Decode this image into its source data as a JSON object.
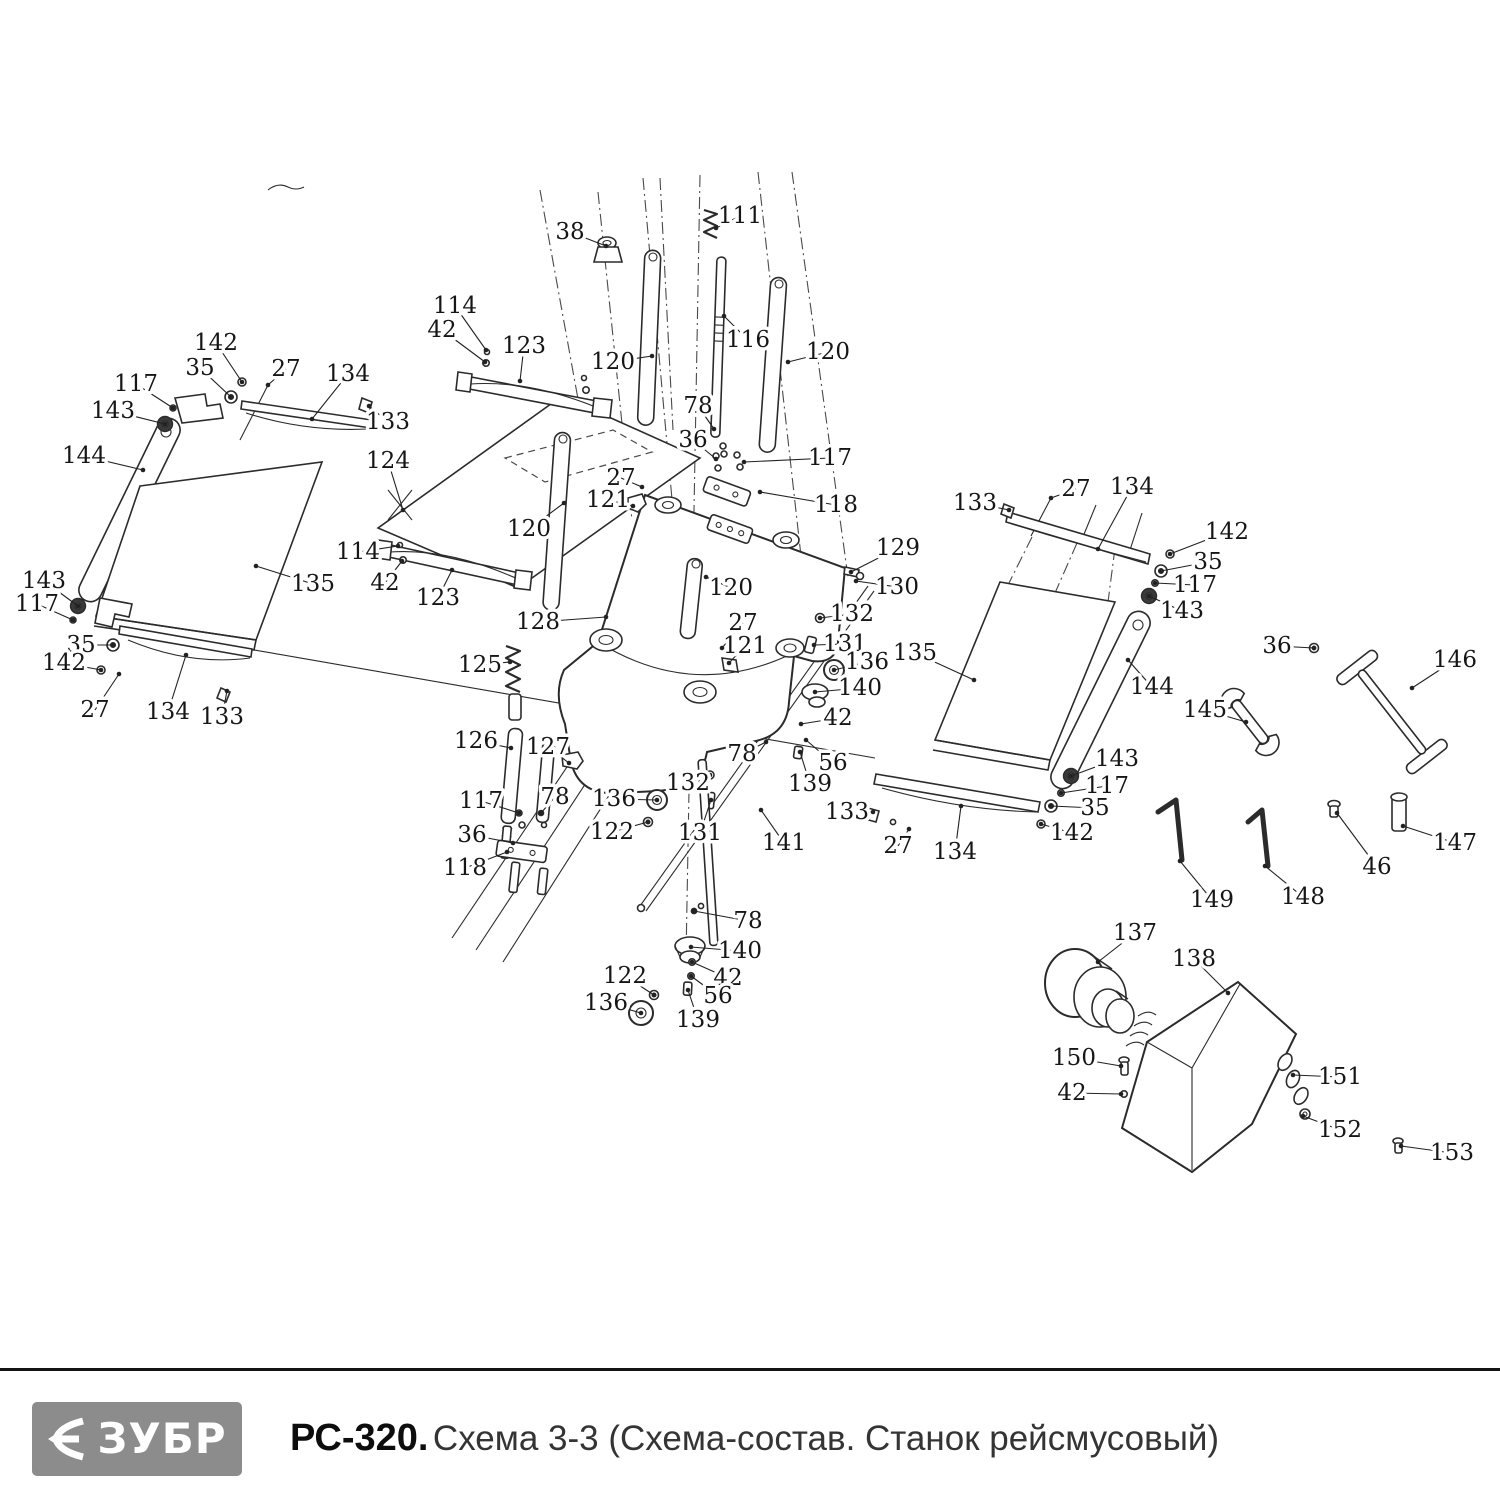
{
  "footer": {
    "brand": "ЗУБР",
    "model": "РС-320.",
    "title": "Схема 3-3 (Схема-состав. Станок рейсмусовый)"
  },
  "diagram": {
    "callouts": [
      {
        "t": "38",
        "x": 570,
        "y": 232,
        "tx": 606,
        "ty": 246
      },
      {
        "t": "111",
        "x": 740,
        "y": 216,
        "tx": 716,
        "ty": 228
      },
      {
        "t": "114",
        "x": 455,
        "y": 306,
        "tx": 486,
        "ty": 350
      },
      {
        "t": "42",
        "x": 442,
        "y": 330,
        "tx": 485,
        "ty": 362
      },
      {
        "t": "123",
        "x": 524,
        "y": 346,
        "tx": 520,
        "ty": 381
      },
      {
        "t": "120",
        "x": 613,
        "y": 362,
        "tx": 652,
        "ty": 356
      },
      {
        "t": "116",
        "x": 748,
        "y": 340,
        "tx": 724,
        "ty": 316
      },
      {
        "t": "120",
        "x": 828,
        "y": 352,
        "tx": 788,
        "ty": 362
      },
      {
        "t": "78",
        "x": 698,
        "y": 406,
        "tx": 714,
        "ty": 429
      },
      {
        "t": "36",
        "x": 693,
        "y": 440,
        "tx": 716,
        "ty": 459
      },
      {
        "t": "117",
        "x": 830,
        "y": 458,
        "tx": 744,
        "ty": 462
      },
      {
        "t": "27",
        "x": 621,
        "y": 478,
        "tx": 642,
        "ty": 487
      },
      {
        "t": "121",
        "x": 608,
        "y": 500,
        "tx": 633,
        "ty": 506
      },
      {
        "t": "118",
        "x": 836,
        "y": 505,
        "tx": 760,
        "ty": 492
      },
      {
        "t": "142",
        "x": 216,
        "y": 343,
        "tx": 242,
        "ty": 382
      },
      {
        "t": "35",
        "x": 200,
        "y": 368,
        "tx": 231,
        "ty": 397
      },
      {
        "t": "27",
        "x": 286,
        "y": 369,
        "tx": 268,
        "ty": 385
      },
      {
        "t": "134",
        "x": 348,
        "y": 374,
        "tx": 312,
        "ty": 419
      },
      {
        "t": "117",
        "x": 136,
        "y": 384,
        "tx": 173,
        "ty": 408
      },
      {
        "t": "143",
        "x": 113,
        "y": 411,
        "tx": 165,
        "ty": 424
      },
      {
        "t": "133",
        "x": 388,
        "y": 422,
        "tx": 369,
        "ty": 406
      },
      {
        "t": "144",
        "x": 84,
        "y": 456,
        "tx": 143,
        "ty": 470
      },
      {
        "t": "124",
        "x": 388,
        "y": 461,
        "tx": 403,
        "ty": 510
      },
      {
        "t": "114",
        "x": 358,
        "y": 552,
        "tx": 398,
        "ty": 546
      },
      {
        "t": "42",
        "x": 385,
        "y": 583,
        "tx": 402,
        "ty": 561
      },
      {
        "t": "123",
        "x": 438,
        "y": 598,
        "tx": 452,
        "ty": 570
      },
      {
        "t": "135",
        "x": 313,
        "y": 584,
        "tx": 256,
        "ty": 566
      },
      {
        "t": "143",
        "x": 44,
        "y": 581,
        "tx": 78,
        "ty": 606
      },
      {
        "t": "117",
        "x": 37,
        "y": 604,
        "tx": 73,
        "ty": 620
      },
      {
        "t": "35",
        "x": 81,
        "y": 645,
        "tx": 113,
        "ty": 645
      },
      {
        "t": "142",
        "x": 64,
        "y": 663,
        "tx": 101,
        "ty": 670
      },
      {
        "t": "27",
        "x": 95,
        "y": 710,
        "tx": 119,
        "ty": 674
      },
      {
        "t": "134",
        "x": 168,
        "y": 712,
        "tx": 186,
        "ty": 655
      },
      {
        "t": "133",
        "x": 222,
        "y": 717,
        "tx": 227,
        "ty": 691
      },
      {
        "t": "120",
        "x": 529,
        "y": 529,
        "tx": 564,
        "ty": 503
      },
      {
        "t": "128",
        "x": 538,
        "y": 622,
        "tx": 606,
        "ty": 617
      },
      {
        "t": "125",
        "x": 480,
        "y": 665,
        "tx": 510,
        "ty": 662
      },
      {
        "t": "126",
        "x": 476,
        "y": 741,
        "tx": 511,
        "ty": 748
      },
      {
        "t": "127",
        "x": 548,
        "y": 747,
        "tx": 569,
        "ty": 763
      },
      {
        "t": "78",
        "x": 555,
        "y": 797,
        "tx": 541,
        "ty": 813
      },
      {
        "t": "117",
        "x": 481,
        "y": 801,
        "tx": 519,
        "ty": 813
      },
      {
        "t": "136",
        "x": 614,
        "y": 799,
        "tx": 657,
        "ty": 800
      },
      {
        "t": "36",
        "x": 472,
        "y": 835,
        "tx": 513,
        "ty": 843
      },
      {
        "t": "122",
        "x": 612,
        "y": 832,
        "tx": 648,
        "ty": 822
      },
      {
        "t": "132",
        "x": 688,
        "y": 783,
        "tx": 710,
        "ty": 775
      },
      {
        "t": "131",
        "x": 700,
        "y": 833,
        "tx": 711,
        "ty": 800
      },
      {
        "t": "118",
        "x": 465,
        "y": 868,
        "tx": 507,
        "ty": 852
      },
      {
        "t": "129",
        "x": 898,
        "y": 548,
        "tx": 851,
        "ty": 572
      },
      {
        "t": "130",
        "x": 897,
        "y": 587,
        "tx": 856,
        "ty": 581
      },
      {
        "t": "132",
        "x": 852,
        "y": 614,
        "tx": 820,
        "ty": 618
      },
      {
        "t": "27",
        "x": 743,
        "y": 623,
        "tx": 722,
        "ty": 648
      },
      {
        "t": "121",
        "x": 745,
        "y": 646,
        "tx": 729,
        "ty": 663
      },
      {
        "t": "131",
        "x": 845,
        "y": 644,
        "tx": 814,
        "ty": 645
      },
      {
        "t": "136",
        "x": 867,
        "y": 662,
        "tx": 834,
        "ty": 670
      },
      {
        "t": "135",
        "x": 915,
        "y": 653,
        "tx": 974,
        "ty": 680
      },
      {
        "t": "140",
        "x": 860,
        "y": 688,
        "tx": 815,
        "ty": 692
      },
      {
        "t": "42",
        "x": 838,
        "y": 718,
        "tx": 801,
        "ty": 724
      },
      {
        "t": "78",
        "x": 742,
        "y": 754,
        "tx": 766,
        "ty": 742
      },
      {
        "t": "56",
        "x": 833,
        "y": 763,
        "tx": 806,
        "ty": 740
      },
      {
        "t": "139",
        "x": 810,
        "y": 784,
        "tx": 800,
        "ty": 752
      },
      {
        "t": "133",
        "x": 847,
        "y": 812,
        "tx": 873,
        "ty": 812
      },
      {
        "t": "141",
        "x": 784,
        "y": 843,
        "tx": 761,
        "ty": 810
      },
      {
        "t": "27",
        "x": 898,
        "y": 846,
        "tx": 909,
        "ty": 829
      },
      {
        "t": "134",
        "x": 955,
        "y": 852,
        "tx": 961,
        "ty": 806
      },
      {
        "t": "78",
        "x": 748,
        "y": 921,
        "tx": 694,
        "ty": 911
      },
      {
        "t": "140",
        "x": 740,
        "y": 951,
        "tx": 691,
        "ty": 947
      },
      {
        "t": "122",
        "x": 625,
        "y": 976,
        "tx": 654,
        "ty": 995
      },
      {
        "t": "42",
        "x": 728,
        "y": 978,
        "tx": 692,
        "ty": 962
      },
      {
        "t": "56",
        "x": 718,
        "y": 996,
        "tx": 691,
        "ty": 976
      },
      {
        "t": "136",
        "x": 606,
        "y": 1003,
        "tx": 641,
        "ty": 1013
      },
      {
        "t": "139",
        "x": 698,
        "y": 1020,
        "tx": 688,
        "ty": 990
      },
      {
        "t": "133",
        "x": 975,
        "y": 503,
        "tx": 1009,
        "ty": 510
      },
      {
        "t": "27",
        "x": 1076,
        "y": 489,
        "tx": 1051,
        "ty": 498
      },
      {
        "t": "134",
        "x": 1132,
        "y": 487,
        "tx": 1098,
        "ty": 549
      },
      {
        "t": "142",
        "x": 1227,
        "y": 532,
        "tx": 1170,
        "ty": 554
      },
      {
        "t": "35",
        "x": 1208,
        "y": 562,
        "tx": 1161,
        "ty": 571
      },
      {
        "t": "117",
        "x": 1195,
        "y": 585,
        "tx": 1155,
        "ty": 583
      },
      {
        "t": "143",
        "x": 1182,
        "y": 611,
        "tx": 1149,
        "ty": 596
      },
      {
        "t": "36",
        "x": 1277,
        "y": 646,
        "tx": 1314,
        "ty": 648
      },
      {
        "t": "146",
        "x": 1455,
        "y": 660,
        "tx": 1412,
        "ty": 688
      },
      {
        "t": "144",
        "x": 1152,
        "y": 687,
        "tx": 1128,
        "ty": 660
      },
      {
        "t": "145",
        "x": 1205,
        "y": 710,
        "tx": 1246,
        "ty": 722
      },
      {
        "t": "143",
        "x": 1117,
        "y": 759,
        "tx": 1071,
        "ty": 776
      },
      {
        "t": "117",
        "x": 1107,
        "y": 786,
        "tx": 1061,
        "ty": 793
      },
      {
        "t": "35",
        "x": 1095,
        "y": 808,
        "tx": 1051,
        "ty": 806
      },
      {
        "t": "142",
        "x": 1072,
        "y": 833,
        "tx": 1041,
        "ty": 824
      },
      {
        "t": "147",
        "x": 1455,
        "y": 843,
        "tx": 1403,
        "ty": 826
      },
      {
        "t": "46",
        "x": 1377,
        "y": 867,
        "tx": 1337,
        "ty": 813
      },
      {
        "t": "148",
        "x": 1303,
        "y": 897,
        "tx": 1265,
        "ty": 866
      },
      {
        "t": "149",
        "x": 1212,
        "y": 900,
        "tx": 1180,
        "ty": 861
      },
      {
        "t": "137",
        "x": 1135,
        "y": 933,
        "tx": 1098,
        "ty": 962
      },
      {
        "t": "138",
        "x": 1194,
        "y": 959,
        "tx": 1228,
        "ty": 993
      },
      {
        "t": "150",
        "x": 1074,
        "y": 1058,
        "tx": 1121,
        "ty": 1066
      },
      {
        "t": "42",
        "x": 1072,
        "y": 1093,
        "tx": 1121,
        "ty": 1094
      },
      {
        "t": "151",
        "x": 1340,
        "y": 1077,
        "tx": 1293,
        "ty": 1075
      },
      {
        "t": "152",
        "x": 1340,
        "y": 1130,
        "tx": 1303,
        "ty": 1116
      },
      {
        "t": "153",
        "x": 1452,
        "y": 1153,
        "tx": 1401,
        "ty": 1146
      },
      {
        "t": "120",
        "x": 731,
        "y": 588,
        "tx": 706,
        "ty": 577
      }
    ]
  }
}
